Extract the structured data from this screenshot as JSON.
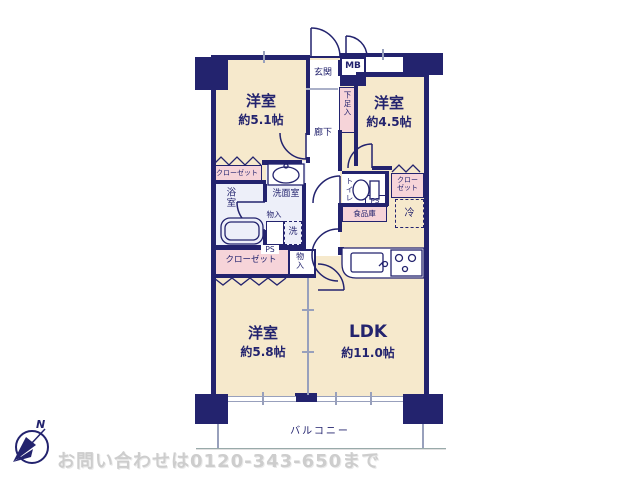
{
  "plan": {
    "rooms": {
      "r51": {
        "name": "洋室",
        "size": "約5.1帖"
      },
      "r45": {
        "name": "洋室",
        "size": "約4.5帖"
      },
      "r58": {
        "name": "洋室",
        "size": "約5.8帖"
      },
      "ldk": {
        "name": "LDK",
        "size": "約11.0帖"
      }
    },
    "labels": {
      "genkan": "玄関",
      "mb": "MB",
      "getabako": "下足入",
      "rouka": "廊下",
      "closet_tl": "クローゼット",
      "bathroom": "浴室",
      "washroom": "洗面室",
      "monoire_wash": "物入",
      "washer": "洗",
      "ps_left": "PS",
      "closet_bl": "クローゼット",
      "monoire_btm": "物入",
      "toilet": "トイレ",
      "ps_right": "PS",
      "closet_r_line1": "クロー",
      "closet_r_line2": "ゼット",
      "fridge": "冷",
      "pantry": "食品庫",
      "balcony": "バルコニー"
    },
    "compass": {
      "north": "N"
    },
    "icons": {
      "compass": "compass-rose"
    },
    "colors": {
      "wall": "#23236e",
      "room_cream": "#f6e9cc",
      "closet_pink": "#f6d4d9",
      "wet_lavender": "#edeff9",
      "window_gray": "#98a0bc",
      "watermark_gray": "#cdcdcd"
    }
  },
  "footer": {
    "watermark": "お問い合わせは0120-343-650まで"
  }
}
